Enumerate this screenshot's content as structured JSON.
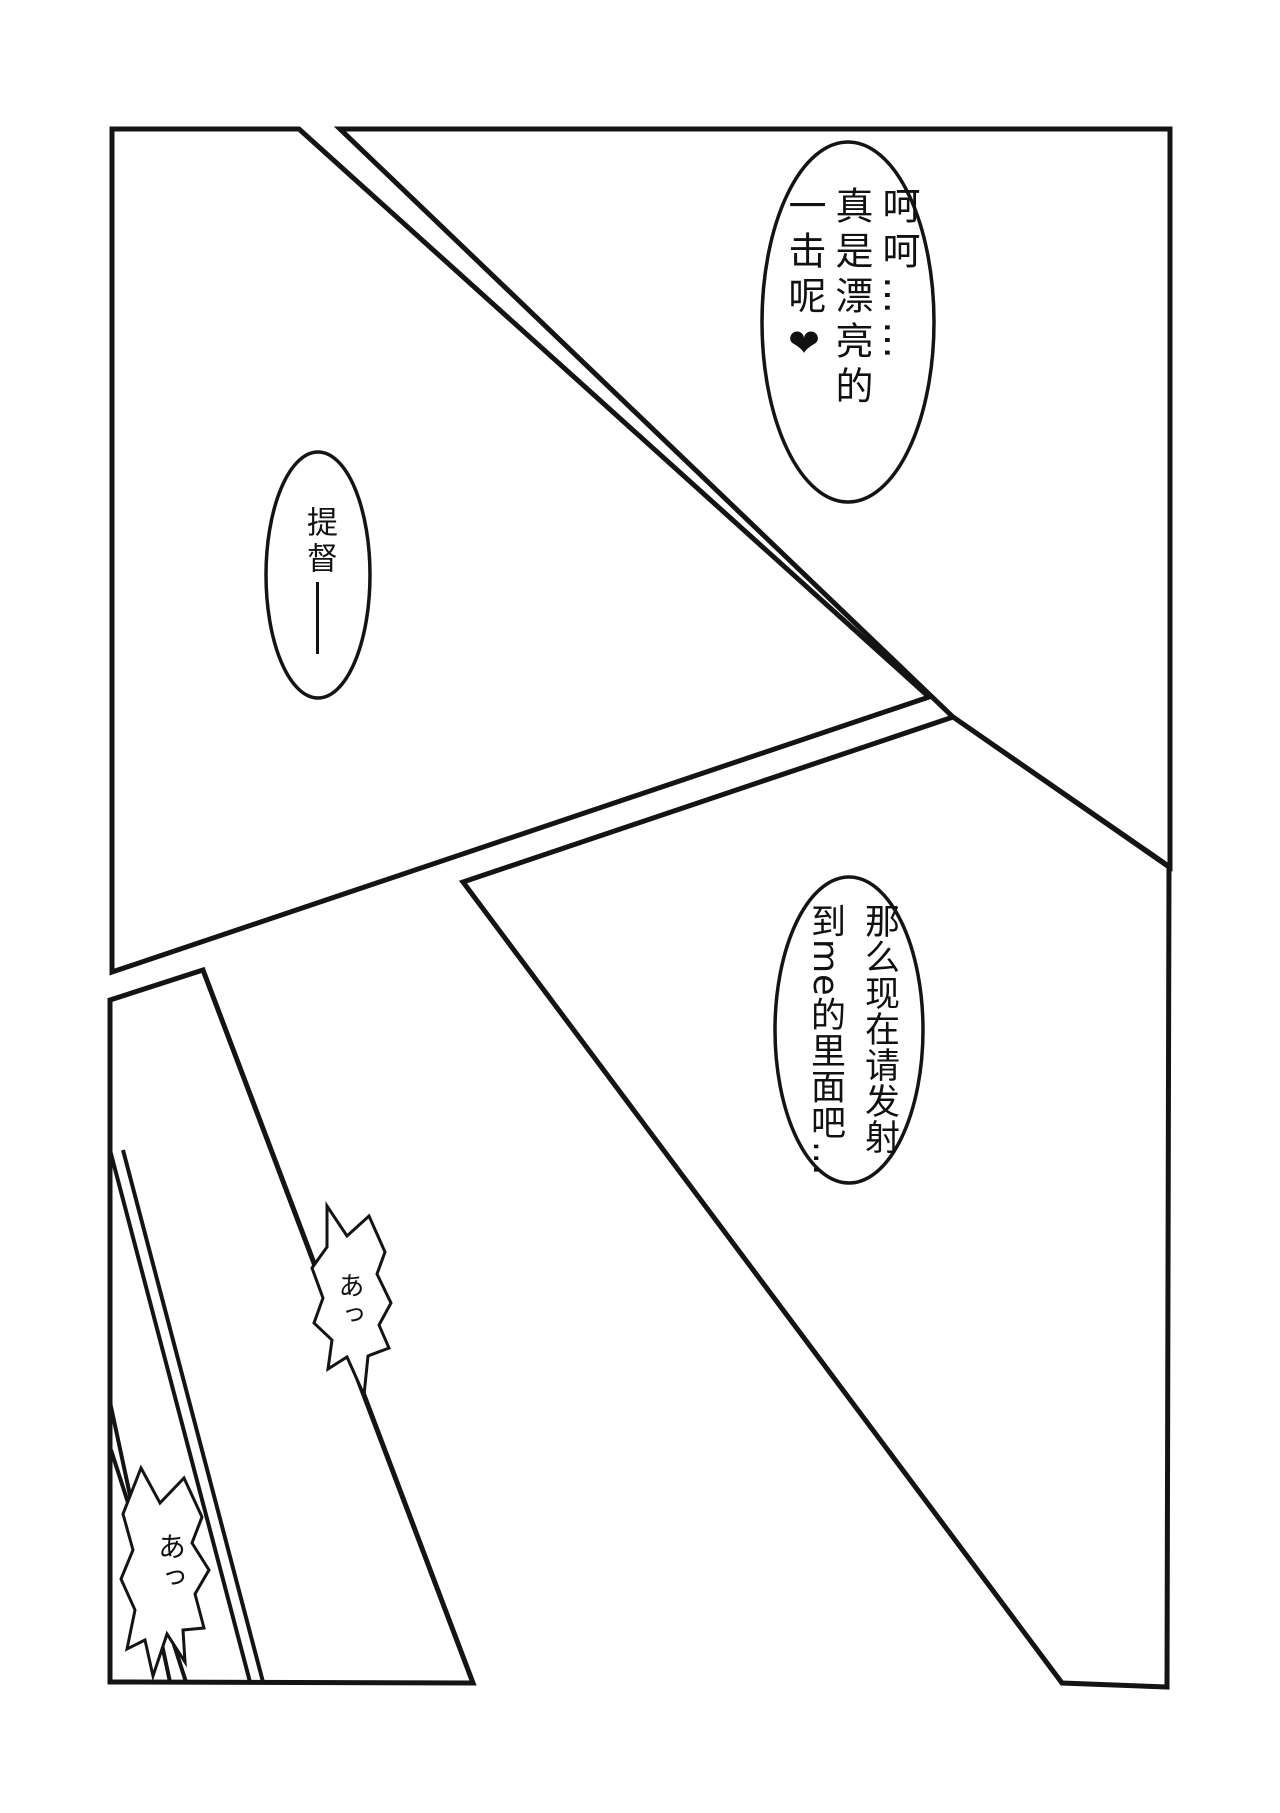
{
  "page": {
    "background": "#ffffff",
    "ink": "#141414"
  },
  "panels": {
    "top_left": {
      "points": "112,129 299,129 929,697 112,972"
    },
    "top_right": {
      "points": "340,129 1170,129 1170,867 953,717"
    },
    "bottom_right": {
      "points": "953,717 1169,867 1167,1687 1062,1683 463,882"
    },
    "bottom_left": {
      "points": "110,1000 203,970 473,1683 110,1682"
    }
  },
  "art_lines": [
    {
      "x1": "110",
      "y1": "1402",
      "x2": "170",
      "y2": "1682"
    },
    {
      "x1": "111",
      "y1": "1450",
      "x2": "186",
      "y2": "1682"
    },
    {
      "x1": "110",
      "y1": "1150",
      "x2": "250",
      "y2": "1682"
    },
    {
      "x1": "123",
      "y1": "1150",
      "x2": "263",
      "y2": "1682"
    }
  ],
  "bubbles": {
    "praise": {
      "cx": "848",
      "cy": "322",
      "rx": "86",
      "ry": "180",
      "text": "呵呵……\n真是漂亮的\n一击呢❤︎"
    },
    "commander": {
      "cx": "318",
      "cy": "575",
      "rx": "52",
      "ry": "123",
      "text": "提督",
      "dash": "──"
    },
    "request": {
      "cx": "849",
      "cy": "1030",
      "rx": "74",
      "ry": "153",
      "text": "那么现在请发射\n到me的里面吧…"
    },
    "gasp1": {
      "points": "327,1206 347,1236 369,1216 385,1252 377,1274 391,1303 379,1325 389,1348 368,1356 364,1395 347,1357 328,1369 332,1340 314,1323 323,1298 312,1268 327,1247",
      "text": "あっ"
    },
    "gasp2": {
      "points": "141,1468 160,1503 184,1478 202,1517 192,1543 209,1570 195,1594 204,1628 183,1630 185,1662 167,1634 153,1676 145,1640 127,1649 135,1610 121,1579 133,1550 123,1514",
      "text": "あっ"
    }
  }
}
